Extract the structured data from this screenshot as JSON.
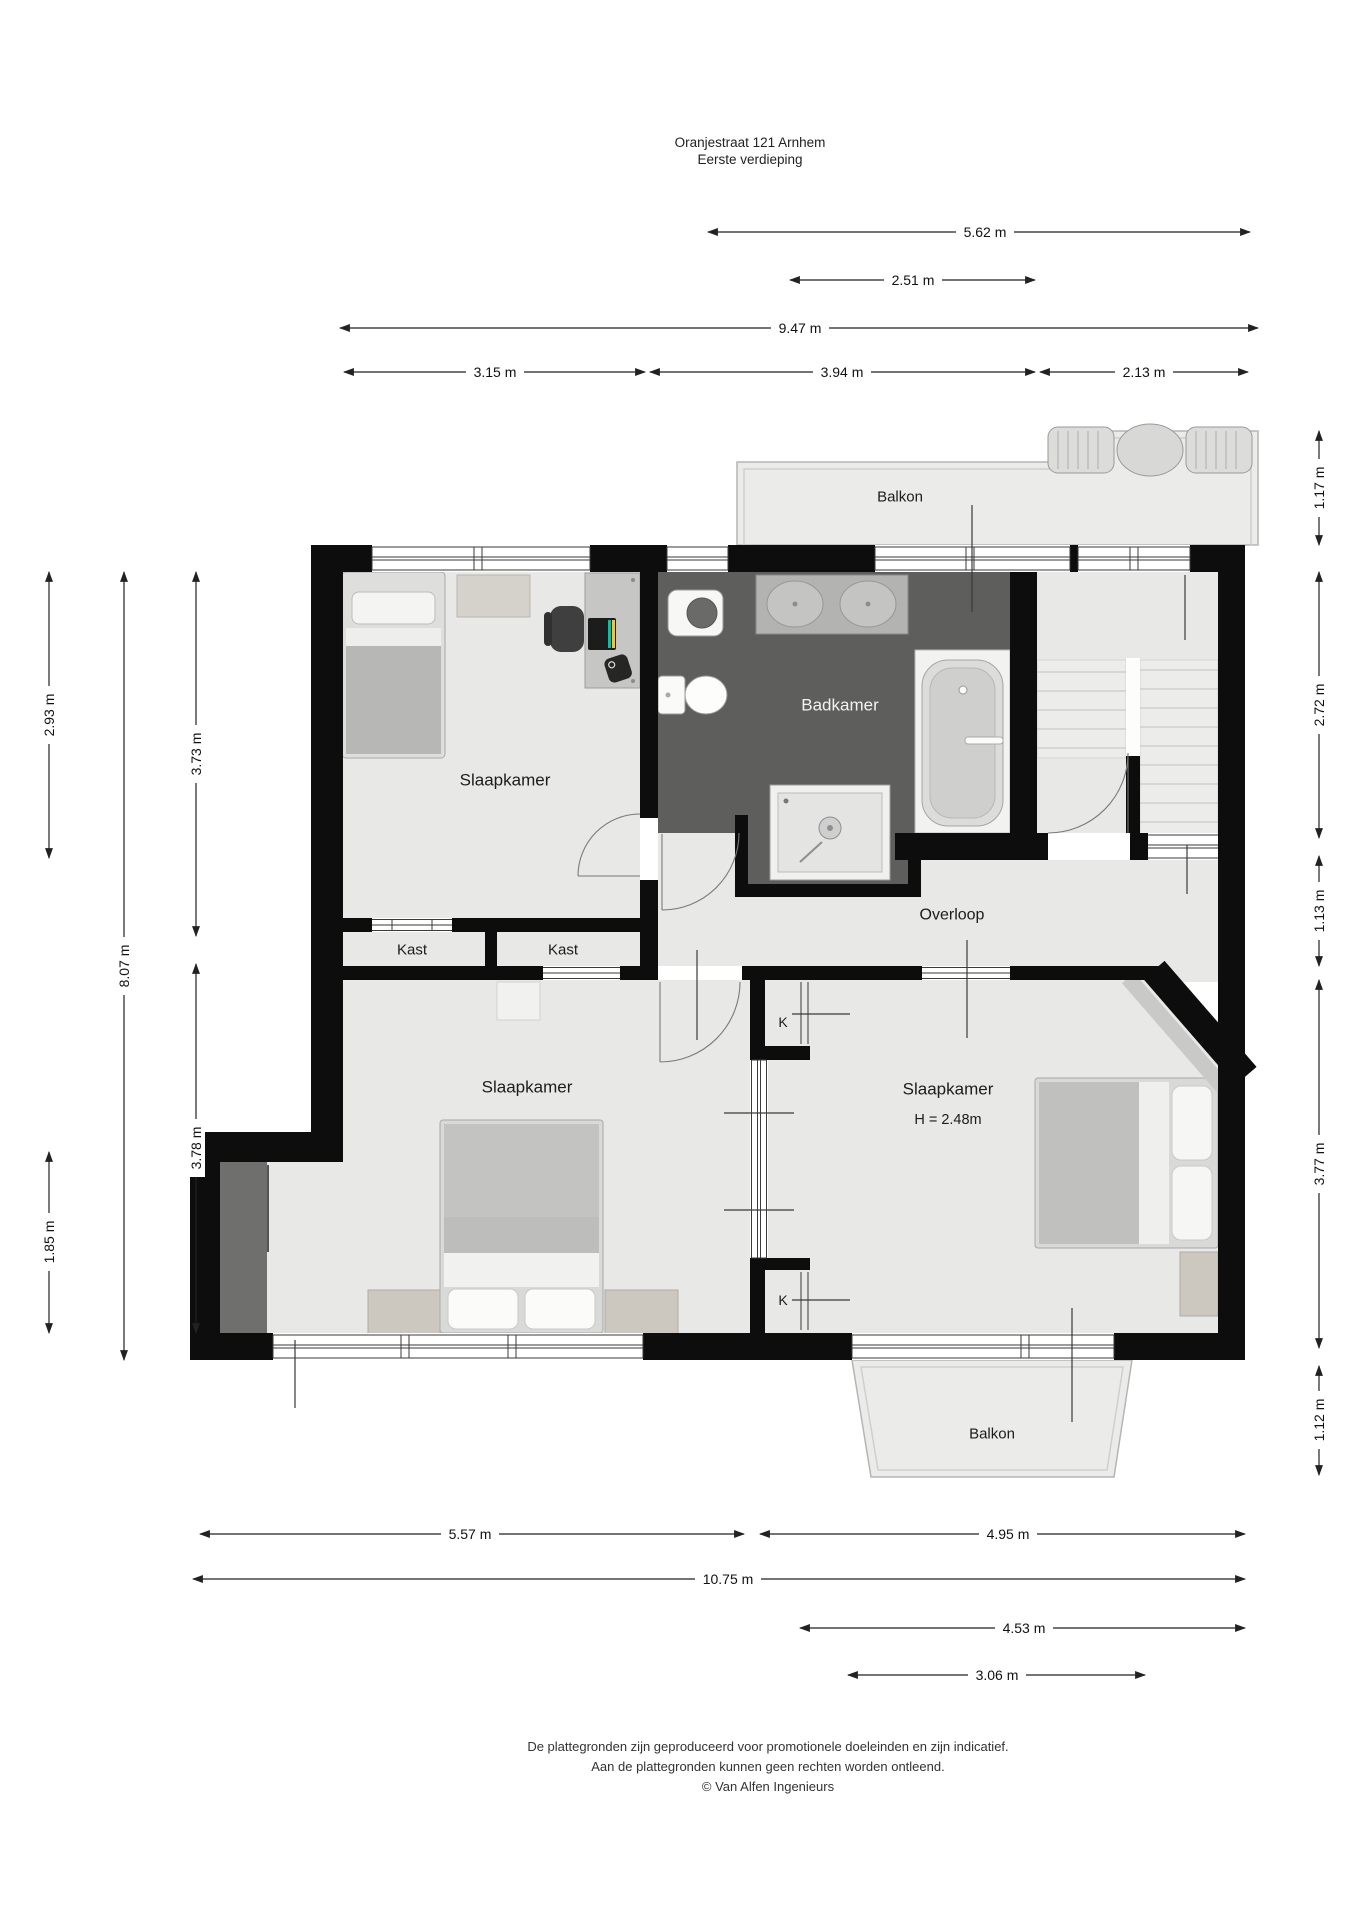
{
  "title": {
    "line1": "Oranjestraat 121 Arnhem",
    "line2": "Eerste verdieping"
  },
  "floorplan": {
    "rooms": {
      "balkon_top": {
        "label": "Balkon"
      },
      "slaapkamer_1": {
        "label": "Slaapkamer"
      },
      "badkamer": {
        "label": "Badkamer"
      },
      "overloop": {
        "label": "Overloop"
      },
      "kast_1": {
        "label": "Kast"
      },
      "kast_2": {
        "label": "Kast"
      },
      "slaapkamer_2": {
        "label": "Slaapkamer"
      },
      "slaapkamer_3": {
        "label": "Slaapkamer",
        "ceiling_height": "H = 2.48m"
      },
      "closet_k_1": {
        "label": "K"
      },
      "closet_k_2": {
        "label": "K"
      },
      "balkon_bottom": {
        "label": "Balkon"
      }
    },
    "dimensions": {
      "top": [
        "5.62 m",
        "2.51 m",
        "9.47 m",
        "3.15 m",
        "3.94 m",
        "2.13 m"
      ],
      "left": [
        "2.93 m",
        "8.07 m",
        "3.73 m",
        "3.78 m",
        "1.85 m"
      ],
      "right": [
        "1.17 m",
        "2.72 m",
        "1.13 m",
        "3.77 m",
        "1.12 m"
      ],
      "bottom": [
        "5.57 m",
        "4.95 m",
        "10.75 m",
        "4.53 m",
        "3.06 m"
      ]
    }
  },
  "footer": {
    "line1": "De plattegronden zijn geproduceerd voor promotionele doeleinden en zijn indicatief.",
    "line2": "Aan de plattegronden kunnen geen rechten worden ontleend.",
    "line3": "© Van Alfen Ingenieurs"
  },
  "colors": {
    "wall": "#0d0d0d",
    "floor": "#e8e8e7",
    "bathroom_floor": "#5e5e5d",
    "balcony": "#ebebea",
    "knee_wall": "#6f6f6e"
  }
}
